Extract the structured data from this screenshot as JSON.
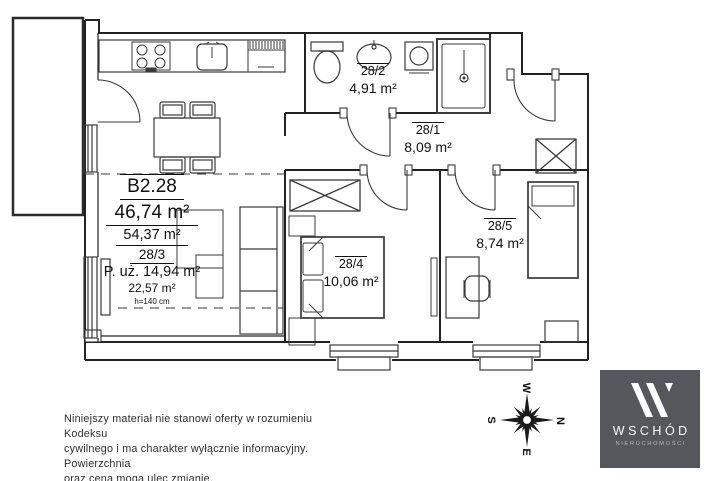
{
  "plan": {
    "unit_label": "B2.28",
    "area_main": "46,74 m²",
    "area_secondary": "54,37 m²",
    "unit_code": "28/3",
    "usable_area": "P. uż. 14,94 m²",
    "area_tertiary": "22,57 m²",
    "height_note": "h=140 cm",
    "rooms": [
      {
        "id": "28/2",
        "area": "4,91 m²"
      },
      {
        "id": "28/1",
        "area": "8,09 m²"
      },
      {
        "id": "28/4",
        "area": "10,06 m²"
      },
      {
        "id": "28/5",
        "area": "8,74 m²"
      }
    ]
  },
  "disclaimer": {
    "line1": "Niniejszy materiał nie stanowi oferty w rozumieniu Kodeksu",
    "line2": "cywilnego i ma charakter wyłącznie informacyjny. Powierzchnia",
    "line3": "oraz cena mogą ulec zmianie."
  },
  "compass": {
    "north": "N",
    "east": "E",
    "south": "S",
    "west": "W"
  },
  "logo": {
    "name": "WSCHÓD",
    "subtitle": "NIERUCHOMOŚCI"
  },
  "colors": {
    "logo_bg": "#54575b",
    "line": "#3a3a3a",
    "wall": "#222222",
    "text": "#111111"
  }
}
